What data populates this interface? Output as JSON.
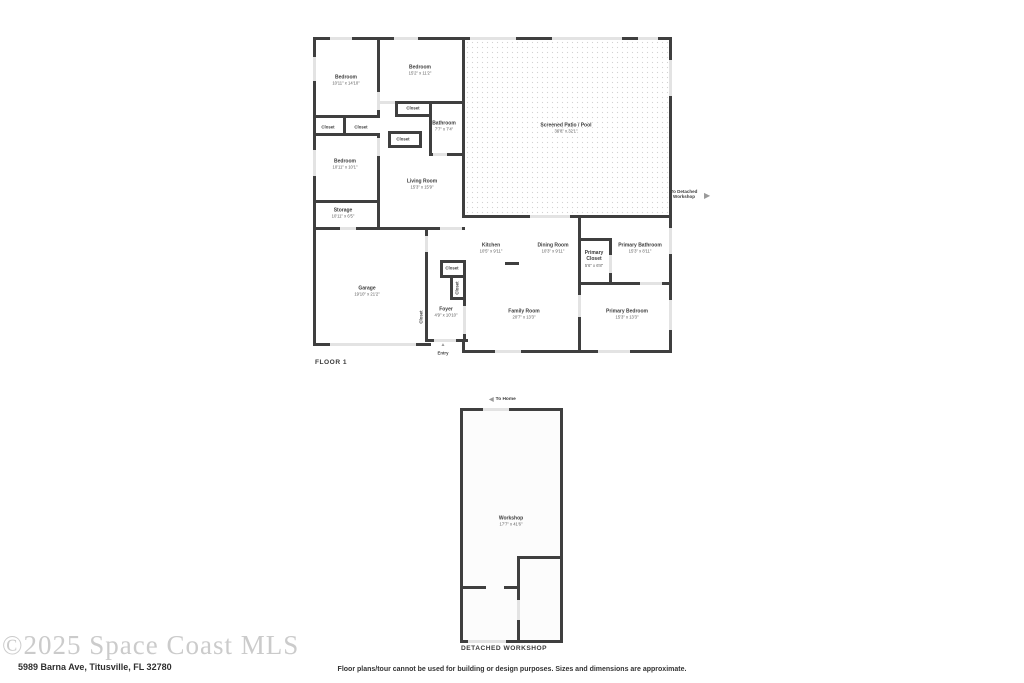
{
  "colors": {
    "wall": "#3f3f3f",
    "opening": "#e3e3e3",
    "label": "#3c3c3c",
    "watermark": "#cbcbcb"
  },
  "floor1": {
    "caption": "FLOOR 1",
    "closet_label": "Closet",
    "entry_label": "Entry",
    "to_workshop_label": "To Detached Workshop",
    "rooms": [
      {
        "name": "Bedroom",
        "dims": "10'11\" x 14'10\""
      },
      {
        "name": "Bedroom",
        "dims": "15'2\" x 11'2\""
      },
      {
        "name": "Bathroom",
        "dims": "7'7\" x 7'4\""
      },
      {
        "name": "Bedroom",
        "dims": "10'11\" x 10'1\""
      },
      {
        "name": "Living Room",
        "dims": "15'3\" x 15'9\""
      },
      {
        "name": "Storage",
        "dims": "10'11\" x 6'5\""
      },
      {
        "name": "Screened Patio / Pool",
        "dims": "36'8\" x 32'1\""
      },
      {
        "name": "Garage",
        "dims": "19'10\" x 21'2\""
      },
      {
        "name": "Kitchen",
        "dims": "10'5\" x 9'11\""
      },
      {
        "name": "Dining Room",
        "dims": "10'3\" x 9'11\""
      },
      {
        "name": "Primary Closet",
        "dims": "5'6\" x 6'8\""
      },
      {
        "name": "Primary Bathroom",
        "dims": "15'3\" x 8'11\""
      },
      {
        "name": "Foyer",
        "dims": "4'9\" x 10'10\""
      },
      {
        "name": "Family Room",
        "dims": "20'7\" x 13'3\""
      },
      {
        "name": "Primary Bedroom",
        "dims": "15'3\" x 13'3\""
      }
    ]
  },
  "workshop": {
    "caption": "DETACHED WORKSHOP",
    "to_home_label": "To Home",
    "room": {
      "name": "Workshop",
      "dims": "17'7\" x 41'6\""
    }
  },
  "icons": {
    "arrow_right": "▶",
    "arrow_left": "◀",
    "entry_arrow": "▲"
  },
  "footer": {
    "watermark": "©2025 Space Coast MLS",
    "address": "5989 Barna Ave, Titusville, FL 32780",
    "disclaimer": "Floor plans/tour cannot be used for building or design purposes. Sizes and dimensions are approximate."
  }
}
